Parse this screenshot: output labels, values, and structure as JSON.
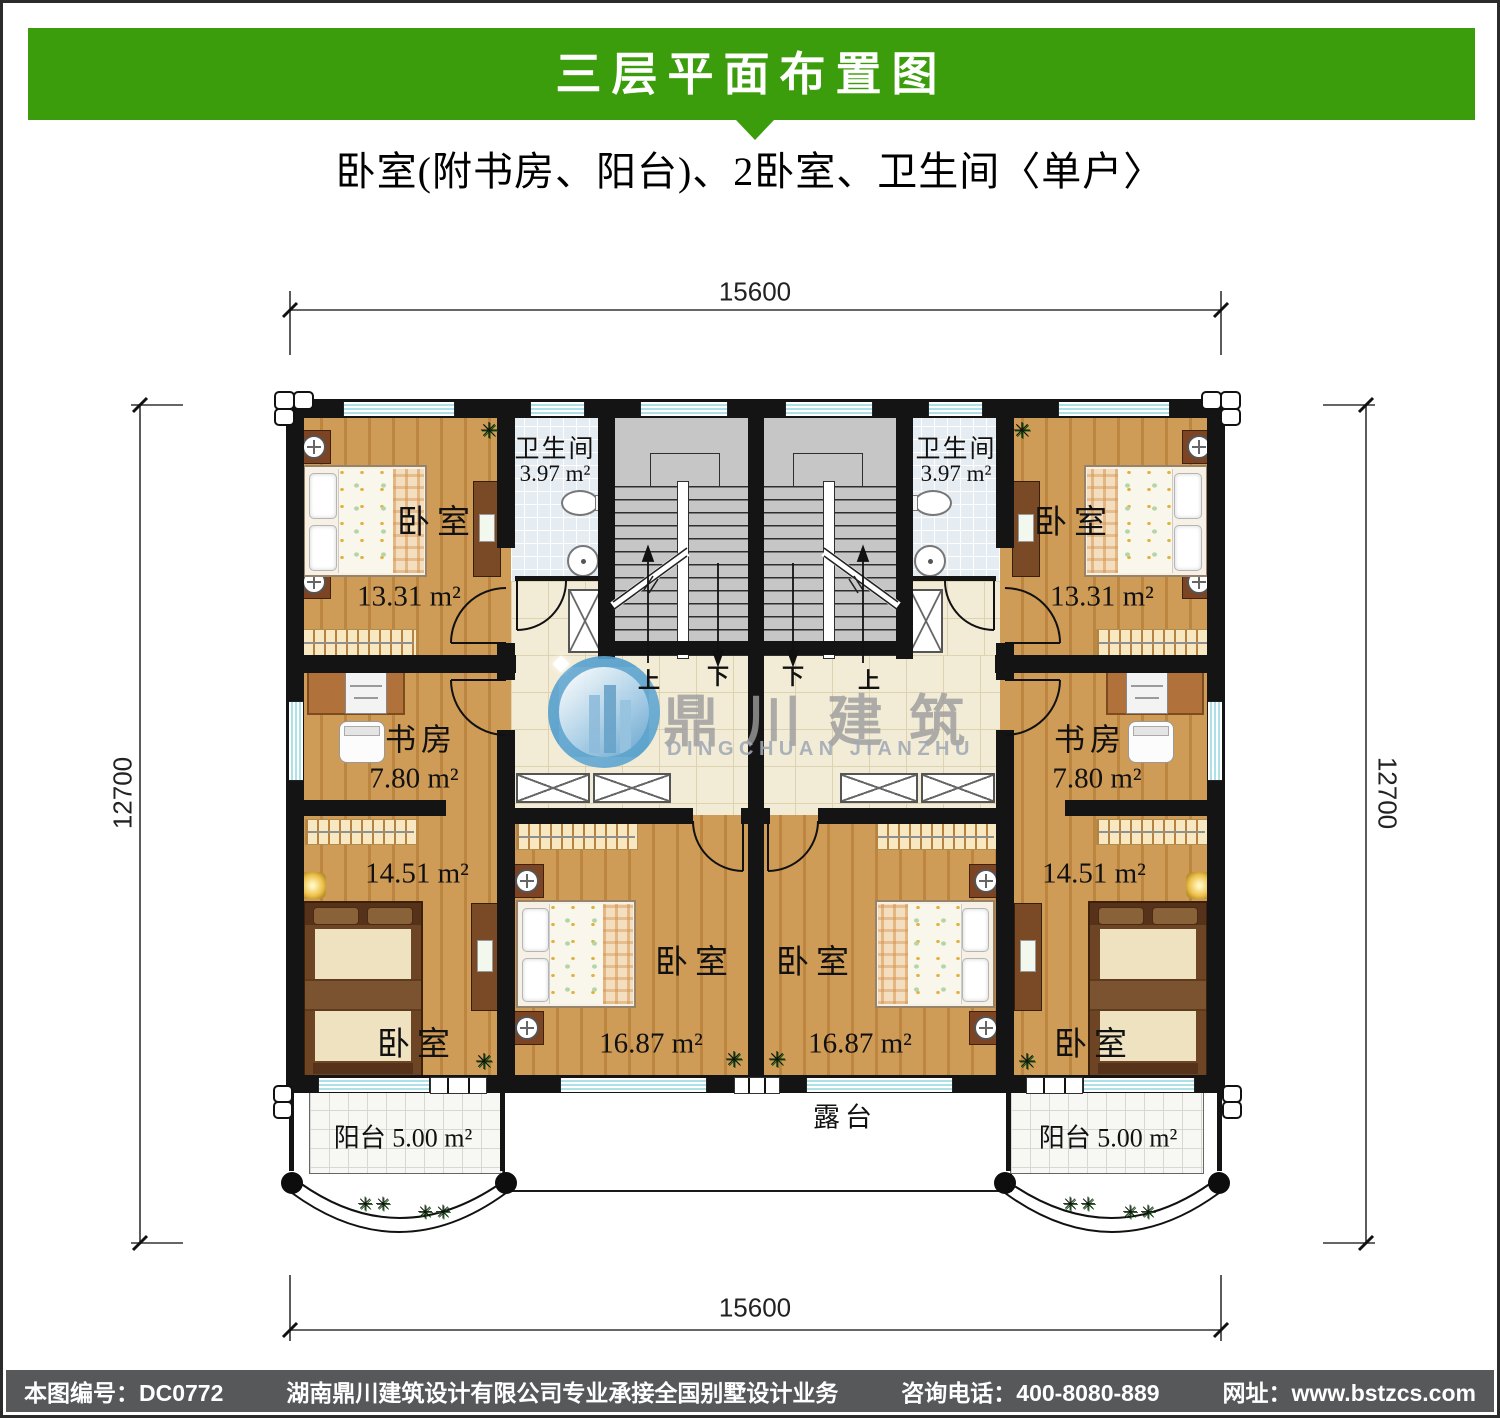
{
  "header": {
    "title": "三层平面布置图",
    "subtitle": "卧室(附书房、阳台)、2卧室、卫生间〈单户〉"
  },
  "watermark": {
    "cn": "鼎川建筑",
    "en": "DINGCHUAN JIANZHU"
  },
  "dimensions": {
    "top": "15600",
    "bottom": "15600",
    "left": "12700",
    "right": "12700"
  },
  "stairs": {
    "up": "上",
    "down": "下"
  },
  "rooms": {
    "bath_left": {
      "name": "卫生间",
      "area": "3.97 m²"
    },
    "bath_right": {
      "name": "卫生间",
      "area": "3.97 m²"
    },
    "bed_tl": {
      "name": "卧室",
      "area": "13.31 m²"
    },
    "bed_tr": {
      "name": "卧室",
      "area": "13.31 m²"
    },
    "study_left": {
      "name": "书房",
      "area": "7.80 m²"
    },
    "study_right": {
      "name": "书房",
      "area": "7.80 m²"
    },
    "bed_ml": {
      "name": "卧室",
      "area": "14.51 m²"
    },
    "bed_mr": {
      "name": "卧室",
      "area": "14.51 m²"
    },
    "bed_cl": {
      "name": "卧室",
      "area": "16.87 m²"
    },
    "bed_cr": {
      "name": "卧室",
      "area": "16.87 m²"
    },
    "balcony_left": {
      "name": "阳台",
      "area": "5.00 m²"
    },
    "balcony_right": {
      "name": "阳台",
      "area": "5.00 m²"
    },
    "terrace": {
      "name": "露台"
    }
  },
  "plants": {
    "glyph": "✳",
    "row": "✳✳"
  },
  "footer": {
    "items": [
      "本图编号：DC0772",
      "湖南鼎川建筑设计有限公司专业承接全国别墅设计业务",
      "咨询电话：400-8080-889",
      "网址：www.bstzcs.com"
    ]
  },
  "colors": {
    "banner_green": "#3B9D0B",
    "footer_bg": "#57585A",
    "wall": "#141414",
    "wood": "#c5914a",
    "bath_tile": "#e6edf2",
    "hall_tile": "#f2ecd7",
    "stair_gray": "#c6c6c6",
    "window_cyan": "#aee0e7",
    "watermark_blue": "#4f9ccb"
  }
}
